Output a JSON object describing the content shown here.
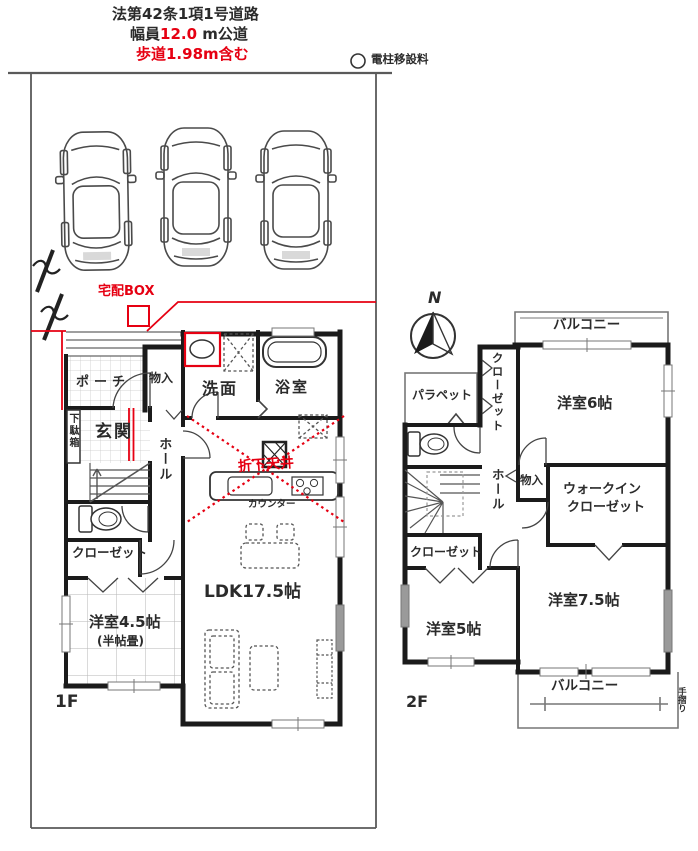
{
  "site": {
    "road_line1": "法第42条1項1号道路",
    "road_width_prefix": "幅員",
    "road_width_value": "12.0",
    "road_width_suffix": " m公道",
    "sidewalk_note": "歩道1.98m含む",
    "utility_pole_note": "電柱移設料",
    "delivery_box_label": "宅配BOX",
    "north_label": "N"
  },
  "floor1": {
    "floor_label": "1F",
    "porch": "ポーチ",
    "storage": "物入",
    "washroom": "洗面",
    "bathroom": "浴室",
    "entrance": "玄関",
    "shoe_cabinet": "下駄箱",
    "hall": "ホール",
    "closet": "クローゼット",
    "bedroom45": "洋室4.5帖",
    "bedroom45_note": "(半帖畳)",
    "ldk": "LDK17.5帖",
    "counter": "カウンター",
    "ceiling_note": "折下天井"
  },
  "floor2": {
    "floor_label": "2F",
    "balcony_north": "バルコニー",
    "closet_north": "クローゼット",
    "bedroom6": "洋室6帖",
    "parapet": "パラペット",
    "hall": "ホール",
    "storage": "物入",
    "wic_line1": "ウォークイン",
    "wic_line2": "クローゼット",
    "closet_west": "クローゼット",
    "bedroom5": "洋室5帖",
    "bedroom75": "洋室7.5帖",
    "balcony_south": "バルコニー",
    "handrail": "手摺り"
  },
  "colors": {
    "accent_red": "#e60012",
    "wall": "#1b1b1b",
    "text": "#2b2b2b"
  }
}
